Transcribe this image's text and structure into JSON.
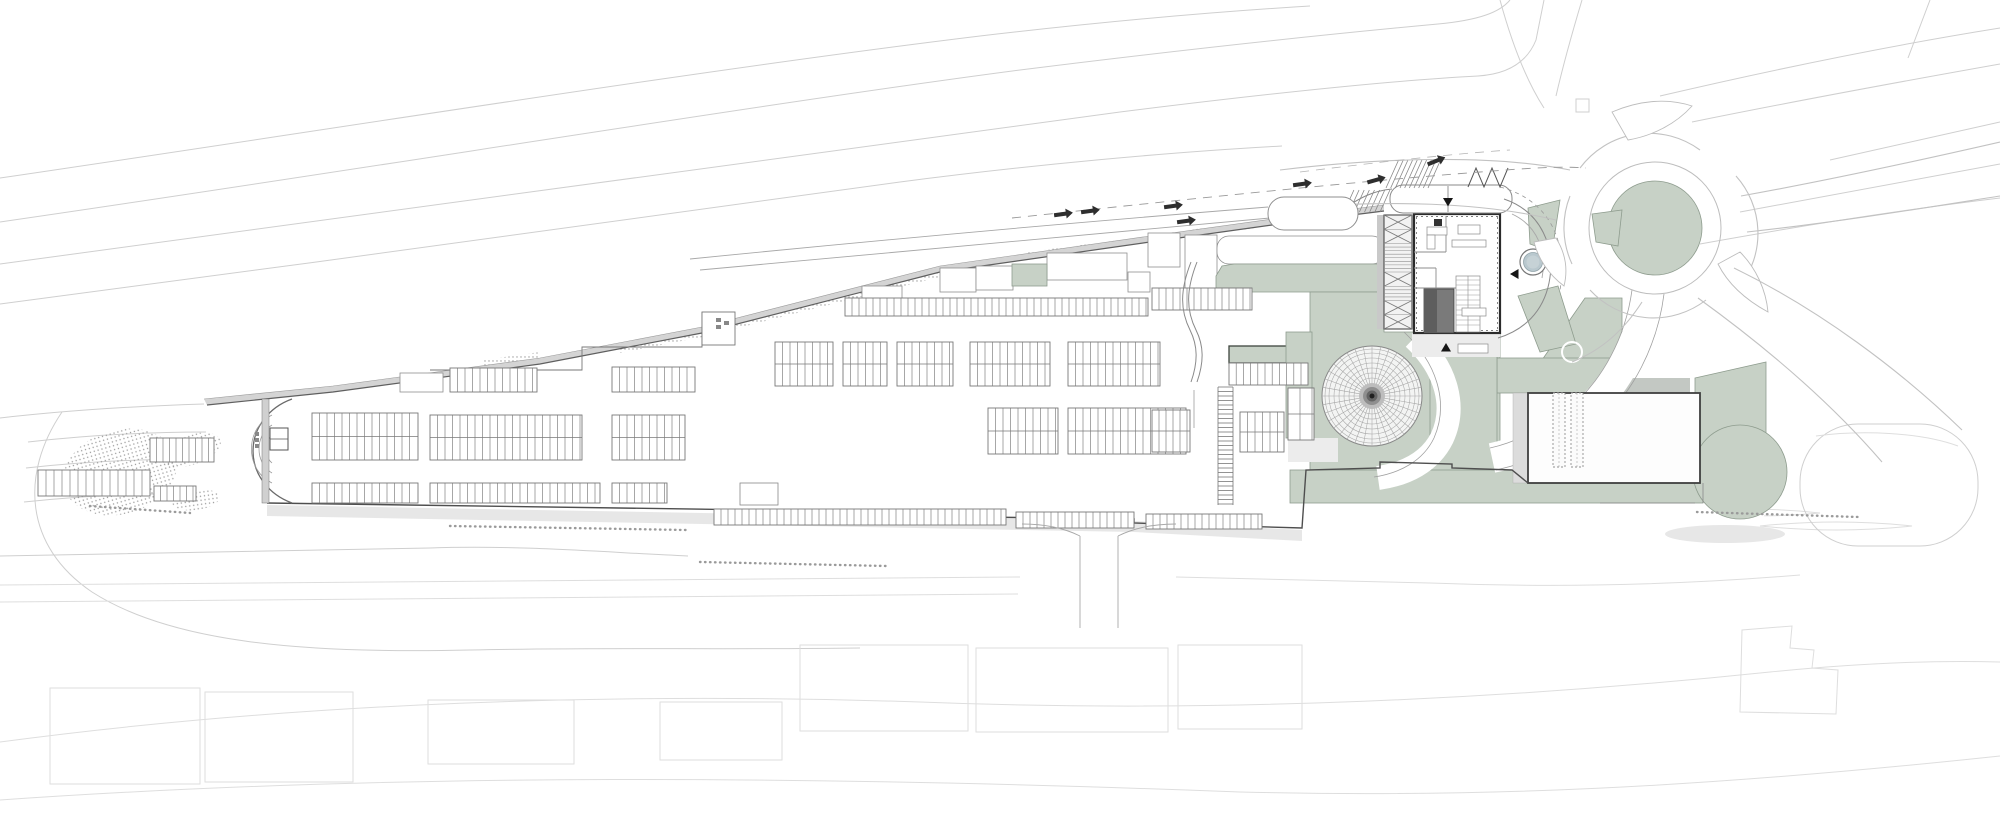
{
  "canvas": {
    "width": 2000,
    "height": 818
  },
  "palette": {
    "background": "#ffffff",
    "sage": "#c7d1c6",
    "sage_border": "#8e9c8e",
    "sage_dark": "#3e463e",
    "line_faint": "#cfcfcf",
    "line_faint2": "#dedede",
    "wall_dark": "#2b2b2b",
    "wall_fill": "#d4d4d4",
    "ink": "#161616",
    "shadow": "#e3e3e3",
    "plaza": "#ececec",
    "pond": "#b9c8ce",
    "dome_line": "#a6a6a6",
    "core_dark": "#5e5e5e",
    "core_mid": "#7a7a7a",
    "stipple": "#9a9a9a"
  },
  "plan": {
    "greens": [
      {
        "x": 1277,
        "y": 205,
        "w": 64,
        "h": 20,
        "rx": 3
      },
      {
        "x": 1012,
        "y": 264,
        "w": 35,
        "h": 22
      },
      {
        "pts": "1216,292 1216,276 1222,266 1234,264 1384,264 1384,292"
      },
      {
        "x": 1229,
        "y": 346,
        "w": 79,
        "h": 17,
        "cls": "dark"
      },
      {
        "pts": "1310,292 1384,292 1384,332 1500,332 1500,470 1310,470"
      },
      {
        "x": 1286,
        "y": 332,
        "w": 26,
        "h": 106
      },
      {
        "pts": "1585,298 1622,298 1622,360 1542,360"
      },
      {
        "x": 1497,
        "y": 358,
        "w": 125,
        "h": 35
      },
      {
        "x": 1430,
        "y": 336,
        "w": 67,
        "h": 147
      },
      {
        "x": 1290,
        "y": 470,
        "w": 413,
        "h": 33
      },
      {
        "pts": "1695,378 1766,362 1766,452 1695,452"
      },
      {
        "cx": 1740,
        "cy": 472,
        "r": 47
      },
      {
        "cx": 1655,
        "cy": 228,
        "r": 47
      },
      {
        "pts": "1528,208 1560,200 1552,252 1530,244"
      },
      {
        "pts": "1592,214 1622,210 1618,246 1596,242"
      },
      {
        "pts": "1518,296 1558,286 1576,344 1540,352"
      }
    ],
    "parking_blocks": [
      {
        "x": 312,
        "y": 413,
        "w": 106,
        "h": 47,
        "rows": 2,
        "pitch": 7.5
      },
      {
        "x": 430,
        "y": 415,
        "w": 152,
        "h": 45,
        "rows": 2,
        "pitch": 7.5
      },
      {
        "x": 612,
        "y": 415,
        "w": 73,
        "h": 45,
        "rows": 2,
        "pitch": 7.5
      },
      {
        "x": 312,
        "y": 483,
        "w": 106,
        "h": 20,
        "rows": 1,
        "pitch": 7.5
      },
      {
        "x": 430,
        "y": 483,
        "w": 170,
        "h": 20,
        "rows": 1,
        "pitch": 7.5
      },
      {
        "x": 612,
        "y": 483,
        "w": 55,
        "h": 20,
        "rows": 1,
        "pitch": 7.5
      },
      {
        "x": 450,
        "y": 368,
        "w": 87,
        "h": 24,
        "rows": 1,
        "pitch": 7.5
      },
      {
        "x": 612,
        "y": 367,
        "w": 83,
        "h": 25,
        "rows": 1,
        "pitch": 7.5
      },
      {
        "x": 775,
        "y": 342,
        "w": 58,
        "h": 44,
        "rows": 2,
        "pitch": 7.5
      },
      {
        "x": 843,
        "y": 342,
        "w": 44,
        "h": 44,
        "rows": 2,
        "pitch": 7.5
      },
      {
        "x": 897,
        "y": 342,
        "w": 56,
        "h": 44,
        "rows": 2,
        "pitch": 7.5
      },
      {
        "x": 970,
        "y": 342,
        "w": 80,
        "h": 44,
        "rows": 2,
        "pitch": 7.5
      },
      {
        "x": 1068,
        "y": 342,
        "w": 92,
        "h": 44,
        "rows": 2,
        "pitch": 7.5
      },
      {
        "x": 988,
        "y": 408,
        "w": 70,
        "h": 46,
        "rows": 2,
        "pitch": 7.5
      },
      {
        "x": 1068,
        "y": 408,
        "w": 118,
        "h": 46,
        "rows": 2,
        "pitch": 7.5
      },
      {
        "x": 845,
        "y": 298,
        "w": 303,
        "h": 18,
        "rows": 1,
        "pitch": 7
      },
      {
        "x": 1152,
        "y": 288,
        "w": 100,
        "h": 22,
        "rows": 1,
        "pitch": 7
      },
      {
        "x": 714,
        "y": 509,
        "w": 292,
        "h": 16,
        "rows": 1,
        "pitch": 7
      },
      {
        "x": 1016,
        "y": 512,
        "w": 118,
        "h": 16,
        "rows": 1,
        "pitch": 7
      },
      {
        "x": 1146,
        "y": 514,
        "w": 116,
        "h": 15,
        "rows": 1,
        "pitch": 7
      },
      {
        "x": 1229,
        "y": 363,
        "w": 79,
        "h": 22,
        "rows": 1,
        "pitch": 7.2
      },
      {
        "x": 1152,
        "y": 410,
        "w": 38,
        "h": 42,
        "rows": 2,
        "pitch": 7
      },
      {
        "x": 1240,
        "y": 412,
        "w": 44,
        "h": 40,
        "rows": 2,
        "pitch": 7.5
      },
      {
        "x": 150,
        "y": 438,
        "w": 64,
        "h": 24,
        "rows": 1,
        "pitch": 6.5
      },
      {
        "x": 154,
        "y": 486,
        "w": 42,
        "h": 15,
        "rows": 1,
        "pitch": 6.5
      },
      {
        "x": 38,
        "y": 470,
        "w": 112,
        "h": 26,
        "rows": 1,
        "pitch": 8
      },
      {
        "x": 1288,
        "y": 388,
        "w": 26,
        "h": 52,
        "rows": 2,
        "pitch": 12
      }
    ],
    "dome": {
      "cx": 1372,
      "cy": 396,
      "r": 50,
      "ring_radii": [
        18,
        23,
        28,
        33,
        38,
        43,
        47
      ],
      "spokes": 36,
      "bullseye": [
        {
          "r": 13,
          "c": "#bdbdbd"
        },
        {
          "r": 9,
          "c": "#8f8f8f"
        },
        {
          "r": 5.5,
          "c": "#646464"
        },
        {
          "r": 2.5,
          "c": "#1f1f1f"
        }
      ]
    },
    "pond": {
      "cx": 1533,
      "cy": 262,
      "r": 13
    },
    "trellis": {
      "x": 1384,
      "y": 215,
      "w": 28,
      "h": 114,
      "rows": 8,
      "x_rows": [
        0,
        1,
        4,
        6,
        7
      ]
    },
    "ladder": {
      "x": 1218,
      "y": 387,
      "w": 15,
      "h": 118,
      "step": 4.5
    },
    "escalators": [
      {
        "x": 1553,
        "y": 393,
        "w": 12,
        "h": 74
      },
      {
        "x": 1571,
        "y": 393,
        "w": 12,
        "h": 74
      }
    ],
    "chains": [
      {
        "x1": 450,
        "y1": 526,
        "x2": 686,
        "y2": 530
      },
      {
        "x1": 700,
        "y1": 562,
        "x2": 886,
        "y2": 566
      },
      {
        "x1": 90,
        "y1": 506,
        "x2": 190,
        "y2": 513
      },
      {
        "x1": 1697,
        "y1": 512,
        "x2": 1858,
        "y2": 517
      }
    ],
    "hatches": [
      {
        "x": 1344,
        "y": 190,
        "w": 36,
        "h": 22,
        "n": 7
      },
      {
        "x": 1386,
        "y": 160,
        "w": 42,
        "h": 28,
        "n": 9
      }
    ],
    "arrows": [
      {
        "x": 1063,
        "y": 214,
        "a": -8
      },
      {
        "x": 1090,
        "y": 211,
        "a": -8
      },
      {
        "x": 1173,
        "y": 206,
        "a": -8
      },
      {
        "x": 1186,
        "y": 221,
        "a": -8
      },
      {
        "x": 1302,
        "y": 184,
        "a": -8
      },
      {
        "x": 1376,
        "y": 180,
        "a": -16
      },
      {
        "x": 1436,
        "y": 161,
        "a": -22
      }
    ],
    "entry_markers": [
      {
        "x": 1443,
        "y": 198,
        "dir": "down"
      },
      {
        "x": 1441,
        "y": 343,
        "dir": "up"
      },
      {
        "x": 1510,
        "y": 269,
        "dir": "left"
      }
    ]
  }
}
